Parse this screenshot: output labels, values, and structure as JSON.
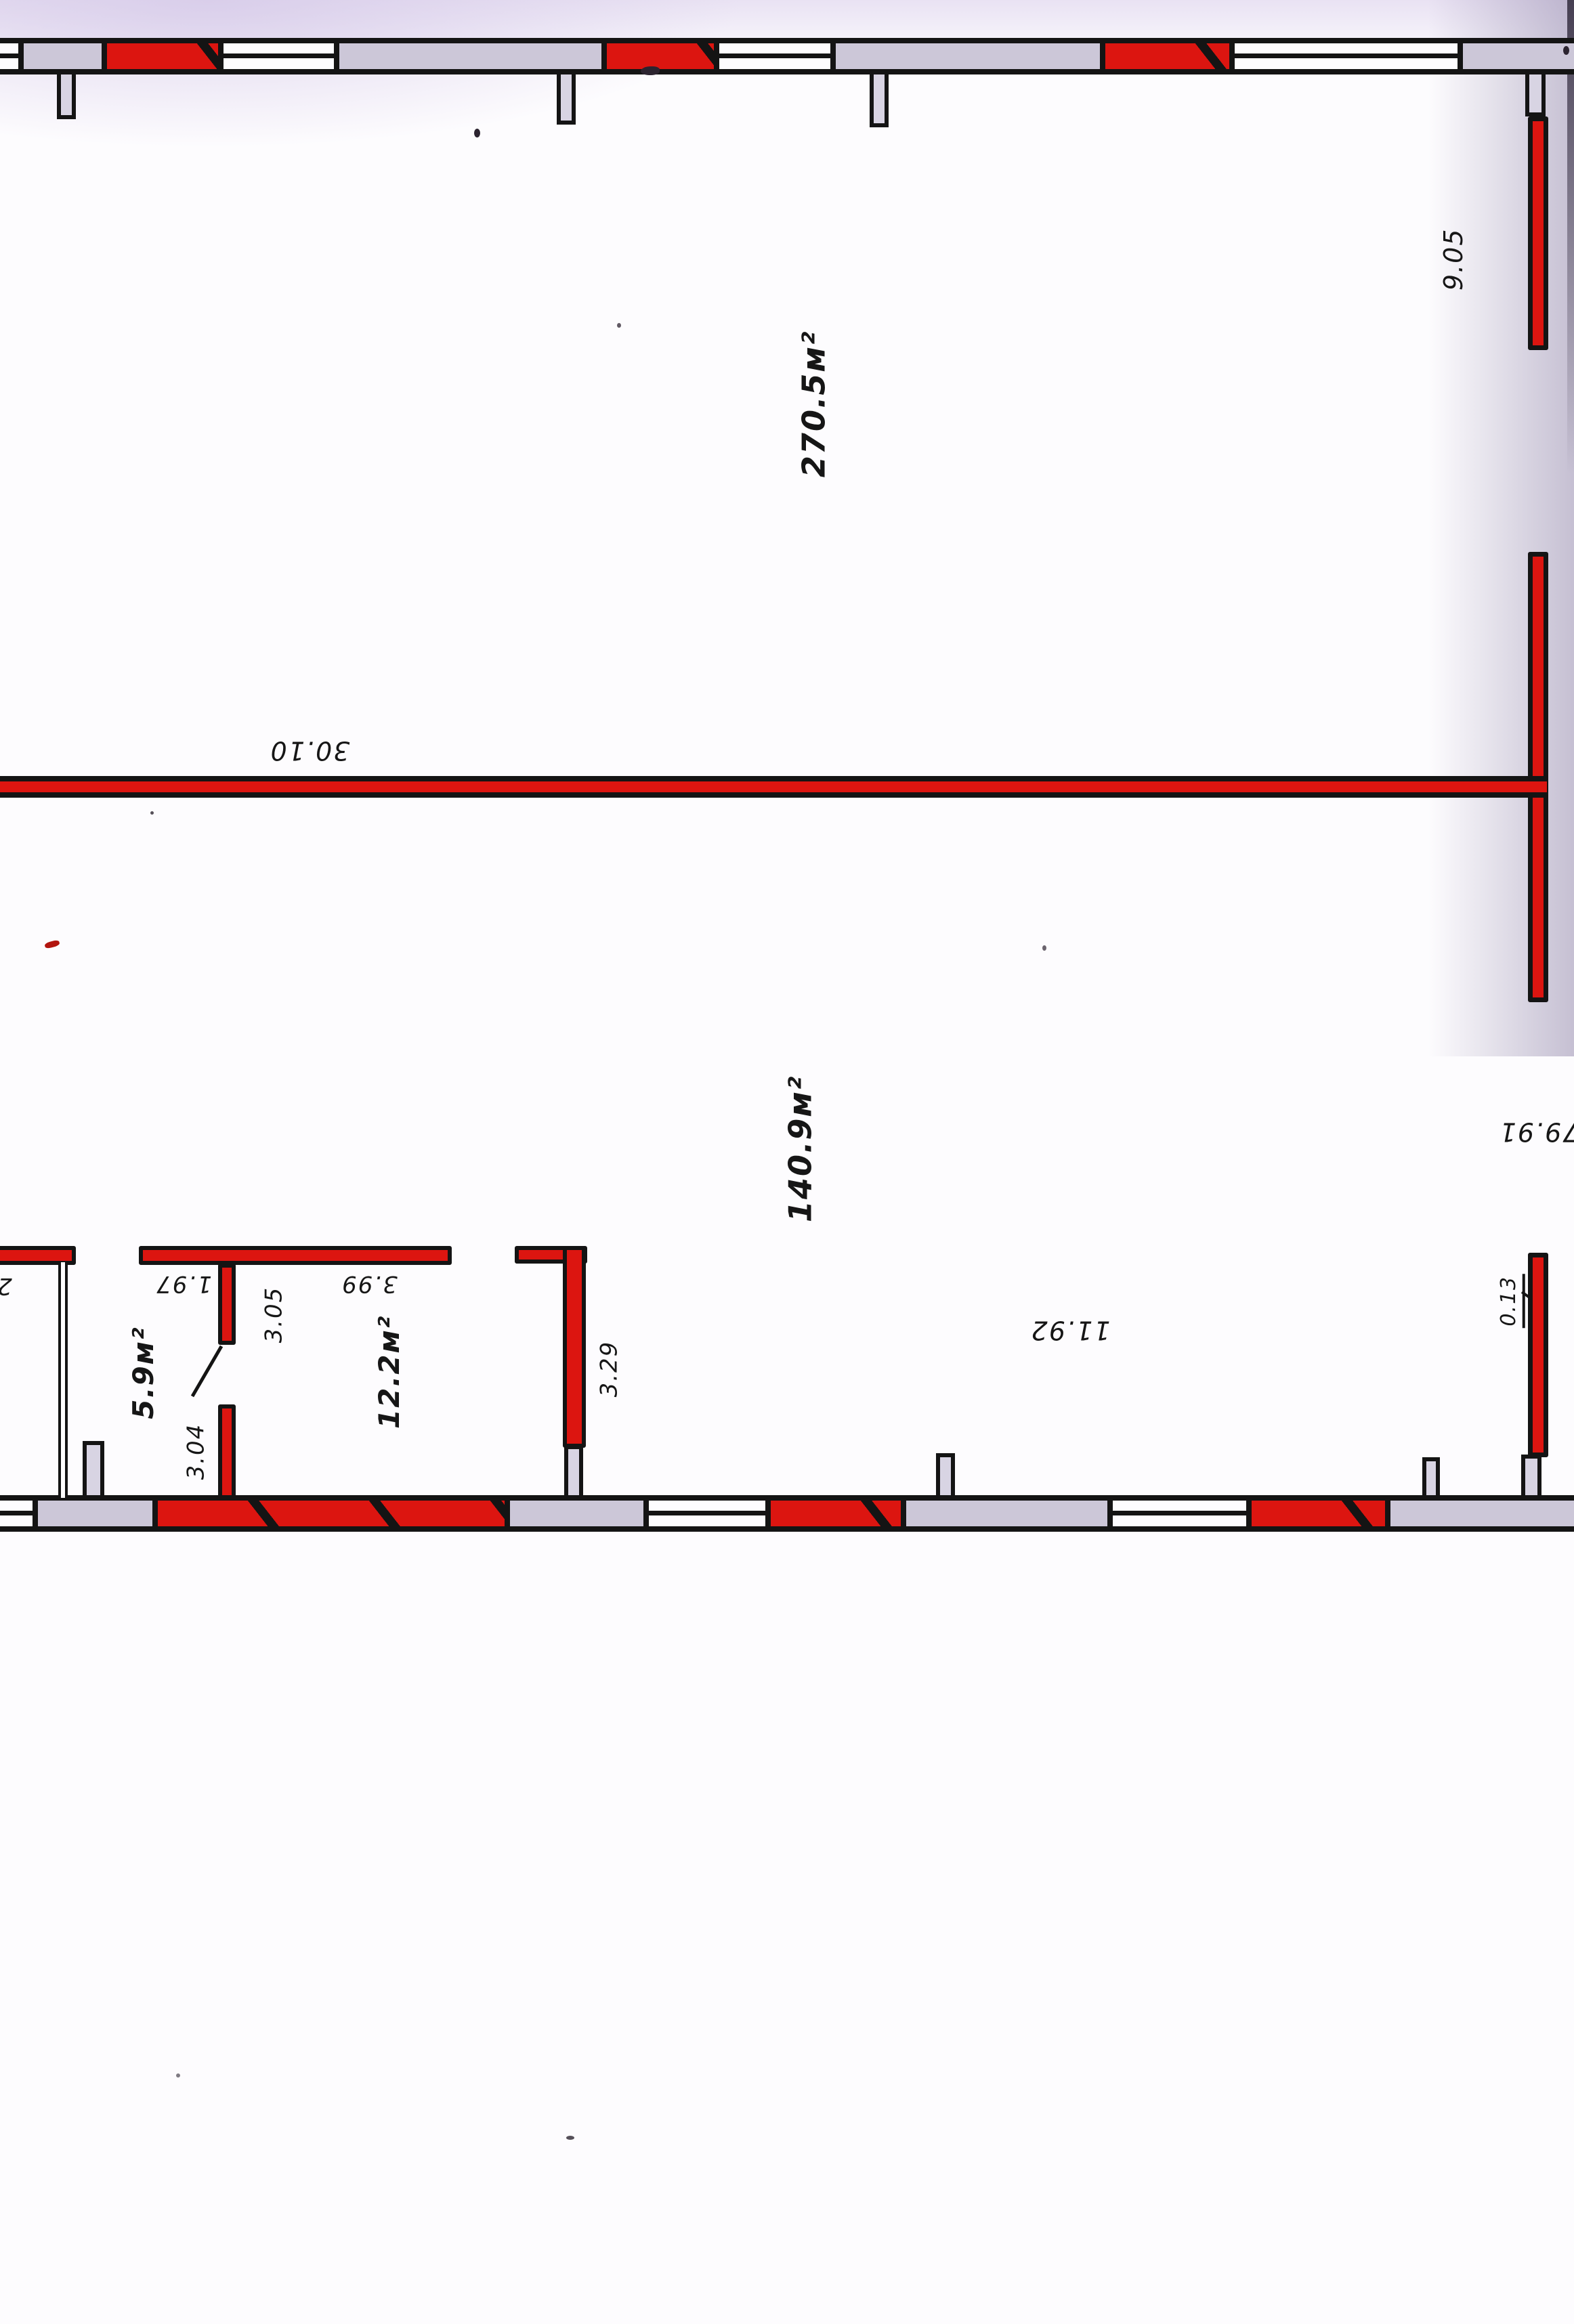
{
  "document": {
    "kind": "scanned floor plan drawing",
    "orientation_note": "plan is rotated 90° on the scanned page"
  },
  "colors": {
    "wall_red": "#dc1510",
    "outline_ink": "#141414",
    "pilaster_gray": "#ccc7d8",
    "paper": "#fdfcfe",
    "scan_shadow": "#cdc3dd"
  },
  "plan": {
    "areas": {
      "hall_large": "270.5м²",
      "hall_medium": "140.9м²",
      "room_small": "5.9м²",
      "room_medium": "12.2м²"
    },
    "dimensions": {
      "right_top": "9.05",
      "middle_span": "30.10",
      "right_lower": "79.91",
      "bottom_span": "11.92",
      "wall_thickness": "0.13",
      "partition_a": "1.97",
      "partition_b": "3.99",
      "partition_c": "3.05",
      "partition_d": "3.04",
      "partition_e": "3.29",
      "edge_partial": "2"
    }
  }
}
